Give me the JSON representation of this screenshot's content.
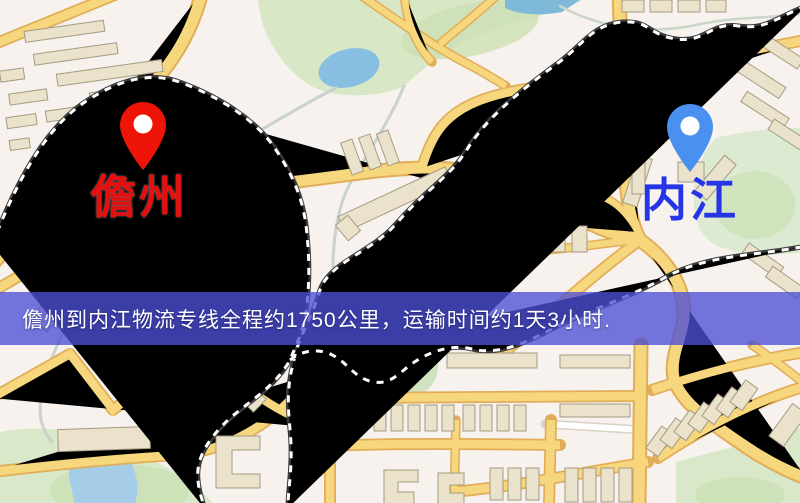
{
  "map": {
    "origin": {
      "label": "儋州",
      "label_color": "#e60f0f",
      "pin_color": "#ee1508"
    },
    "destination": {
      "label": "内江",
      "label_color": "#2636e6",
      "pin_color": "#4a90f0"
    }
  },
  "banner": {
    "text": "儋州到内江物流专线全程约1750公里，运输时间约1天3小时.",
    "distance_text": "约1750公里",
    "duration_text": "约1天3小时",
    "background_color": "#4d50d6",
    "text_color": "#ffffff"
  },
  "map_features": {
    "background_color": "#f7f2ee",
    "major_road_color": "#f6d77d",
    "road_casing_color": "#e2ad58",
    "park_color": "#d8e7c5",
    "water_color": "#87bee2",
    "lake_color": "#7cc0dc",
    "railway_color": "#3a3a3a",
    "building_color": "#eae2ca"
  }
}
